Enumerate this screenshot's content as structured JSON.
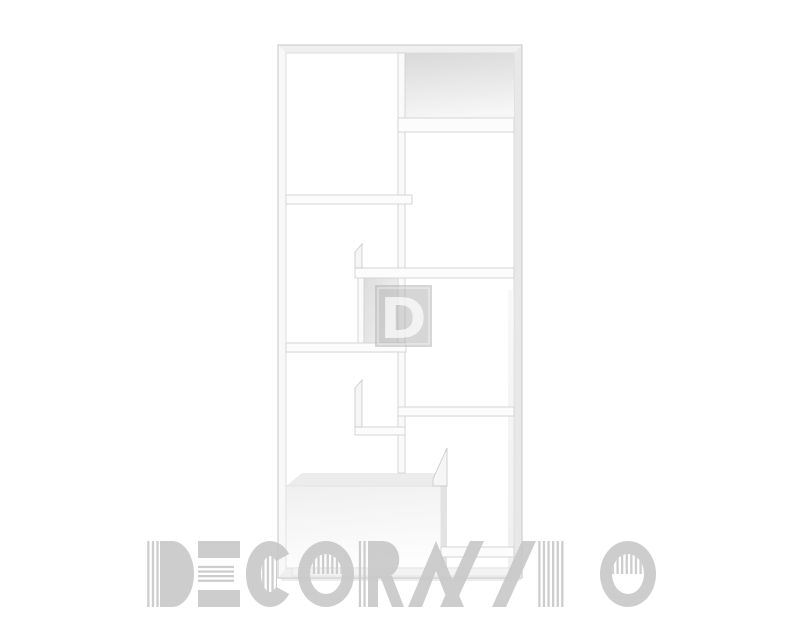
{
  "page": {
    "background_color": "#ffffff"
  },
  "product_image": {
    "alt": "White modular shelving unit with asymmetric compartments",
    "body_color": "#fbfbfb",
    "edge_color": "#d2d2d2",
    "panel_shade_color": "#dedede"
  },
  "watermark": {
    "text": "DECORAZZIO",
    "text_color": "#c9c9c9",
    "logo_letter": "D",
    "logo_square_color": "#aeaeae",
    "logo_letter_color": "#ffffff"
  }
}
